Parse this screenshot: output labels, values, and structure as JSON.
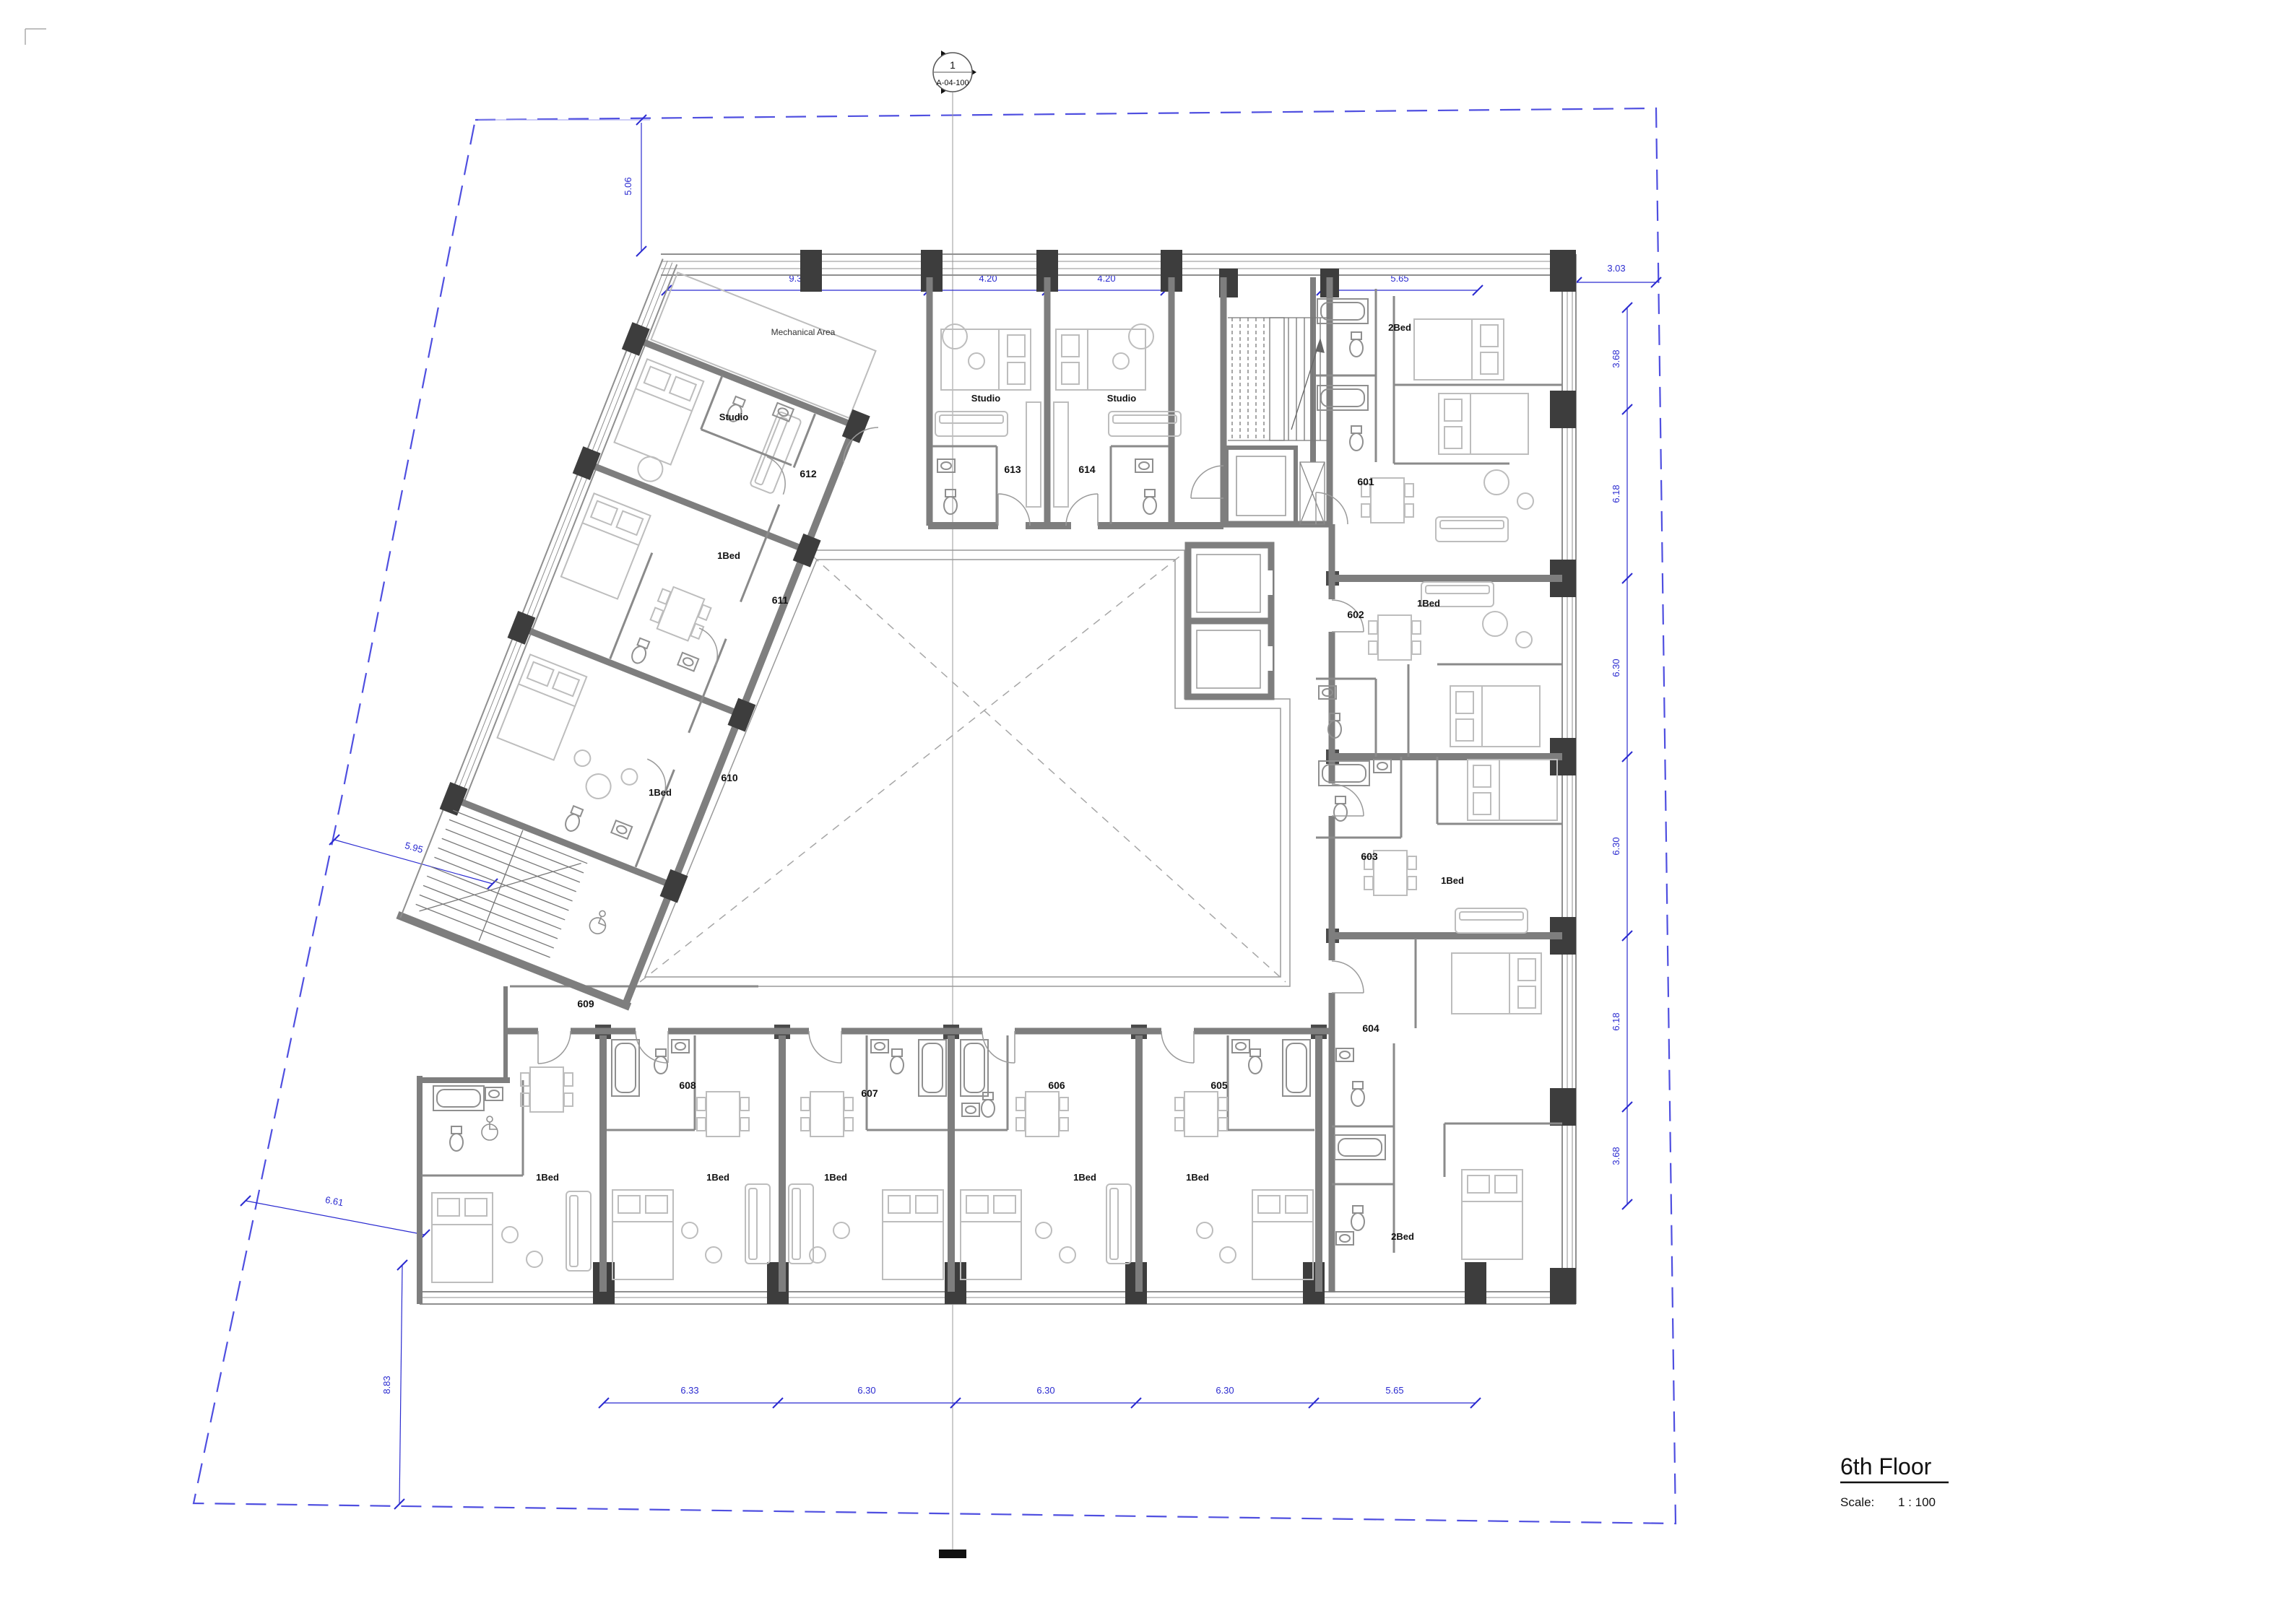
{
  "sheet": {
    "title": "6th Floor",
    "scale_label": "Scale:",
    "scale_value": "1 : 100"
  },
  "section_marker": {
    "number": "1",
    "sheet_ref": "A-04-100"
  },
  "area_labels": {
    "mechanical": "Mechanical Area"
  },
  "units": [
    {
      "number": "601",
      "type": "2Bed"
    },
    {
      "number": "602",
      "type": "1Bed"
    },
    {
      "number": "603",
      "type": "1Bed"
    },
    {
      "number": "604",
      "type": "2Bed"
    },
    {
      "number": "605",
      "type": "1Bed"
    },
    {
      "number": "606",
      "type": "1Bed"
    },
    {
      "number": "607",
      "type": "1Bed"
    },
    {
      "number": "608",
      "type": "1Bed"
    },
    {
      "number": "609",
      "type": "1Bed"
    },
    {
      "number": "610",
      "type": "1Bed"
    },
    {
      "number": "611",
      "type": "1Bed"
    },
    {
      "number": "612",
      "type": "Studio"
    },
    {
      "number": "613",
      "type": "Studio"
    },
    {
      "number": "614",
      "type": "Studio"
    }
  ],
  "dimensions": {
    "top": [
      "9.30",
      "4.20",
      "4.20",
      "5.65"
    ],
    "top_right": "3.03",
    "right": [
      "3.68",
      "6.18",
      "6.30",
      "6.30",
      "6.18",
      "3.68"
    ],
    "bottom": [
      "6.33",
      "6.30",
      "6.30",
      "6.30",
      "5.65"
    ],
    "left_top": "5.06",
    "left_mid": "5.95",
    "left_lower": "6.61",
    "left_bottom": "8.83"
  },
  "colors": {
    "dimension": "#2b2bd0",
    "boundary": "#4f4fe0",
    "wall": "#7e7e7e",
    "column": "#3d3d3d",
    "furniture": "#bdbdbd"
  }
}
